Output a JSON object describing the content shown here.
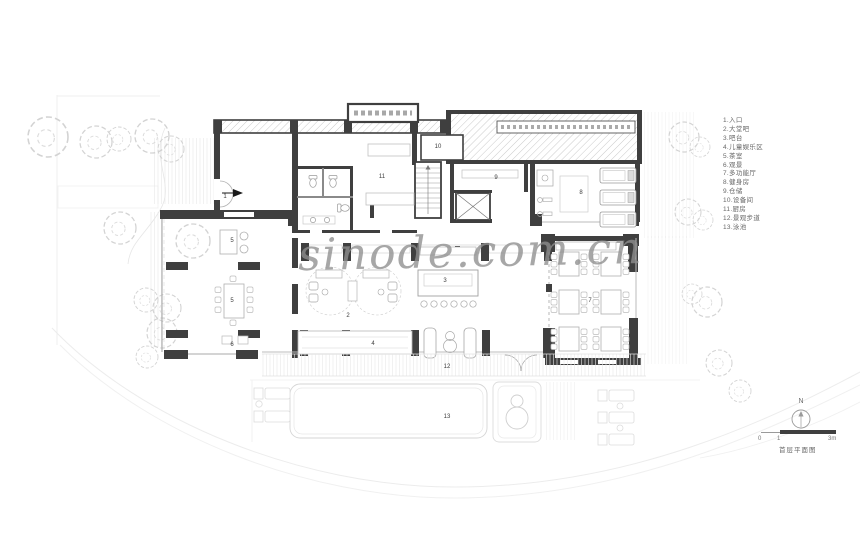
{
  "watermark": "sinode.com.cn",
  "legend": {
    "items": [
      "1.入口",
      "2.大堂吧",
      "3.吧台",
      "4.儿童娱乐区",
      "5.茶室",
      "6.观景",
      "7.多功能厅",
      "8.健身房",
      "9.仓储",
      "10.设备间",
      "11.厨房",
      "12.景观步道",
      "13.泳池"
    ]
  },
  "room_labels": {
    "r1": "1",
    "r2": "2",
    "r3": "3",
    "r4": "4",
    "r5a": "5",
    "r5b": "5",
    "r6": "6",
    "r7": "7",
    "r8": "8",
    "r9": "9",
    "r10": "10",
    "r11": "11",
    "r12": "12",
    "r13": "13"
  },
  "compass": {
    "label": "N"
  },
  "scalebar": {
    "tick0": "0",
    "tick1": "1",
    "tick2": "3m",
    "caption": "首层平面图"
  },
  "colors": {
    "wall": "#3f3f3f",
    "light_line": "#c9c9c9",
    "watermark_gray": "#8f8f8f"
  }
}
